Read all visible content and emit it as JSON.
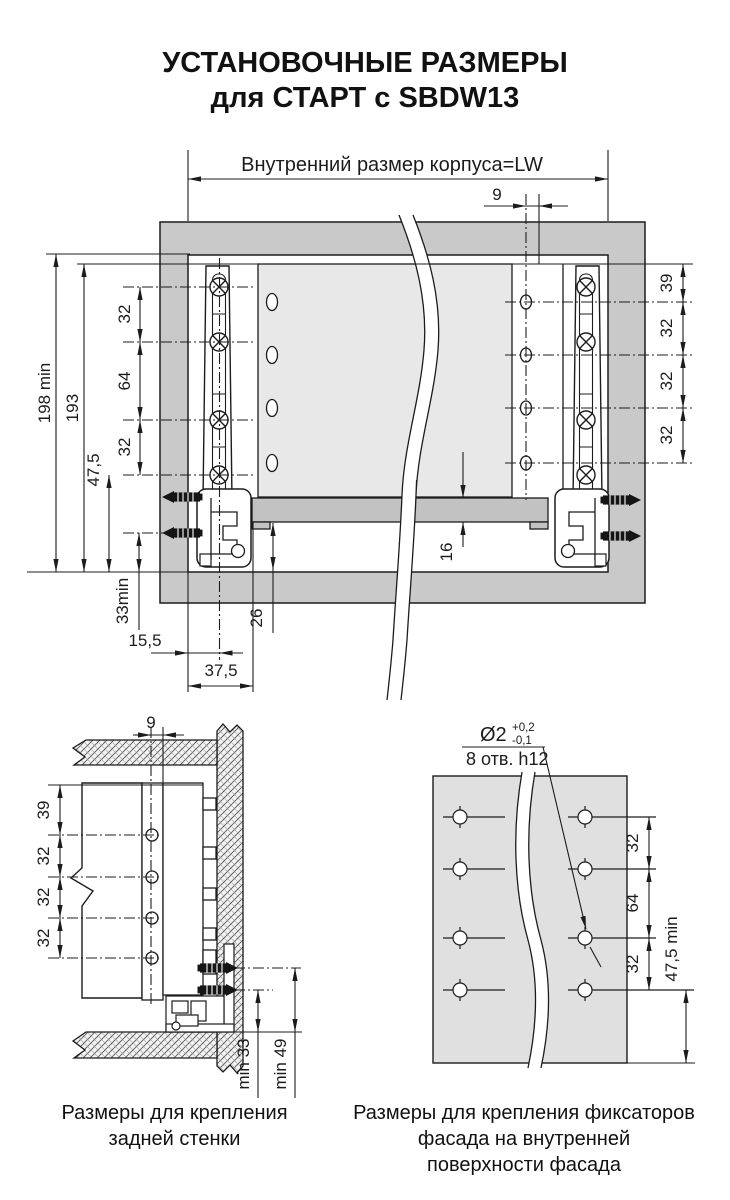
{
  "title": {
    "line1": "УСТАНОВОЧНЫЕ РАЗМЕРЫ",
    "line2": "для СТАРТ с SBDW13"
  },
  "top_view": {
    "cabinet_width_label": "Внутренний размер корпуса=LW",
    "hole_edge_offset": "9",
    "cabinet_height_min": "198 min",
    "rail_top_height": "193",
    "left_screw_spacing": [
      "32",
      "64",
      "32"
    ],
    "slide_screw_bottom_height": "47,5",
    "lock_screw_height": "33min",
    "lock_center_offset": "15,5",
    "slide_center_offset": "37,5",
    "bottom_recess": "26",
    "bottom_panel_thickness": "16",
    "right_hole_spacing": [
      "39",
      "32",
      "32",
      "32"
    ]
  },
  "back_wall_view": {
    "hole_edge_offset": "9",
    "hole_spacing": [
      "39",
      "32",
      "32",
      "32"
    ],
    "lower_screw_min_height": "min 33",
    "upper_screw_min_height": "min 49",
    "caption": [
      "Размеры для крепления",
      "задней стенки"
    ]
  },
  "facade_view": {
    "hole_diameter": "Ø2",
    "tolerance_plus": "+0,2",
    "tolerance_minus": "-0,1",
    "holes_spec": "8 отв. h12",
    "hole_spacing": [
      "32",
      "64",
      "32"
    ],
    "bottom_hole_offset": "47,5 min",
    "caption": [
      "Размеры для крепления фиксаторов",
      "фасада на внутренней",
      "поверхности фасада"
    ]
  }
}
